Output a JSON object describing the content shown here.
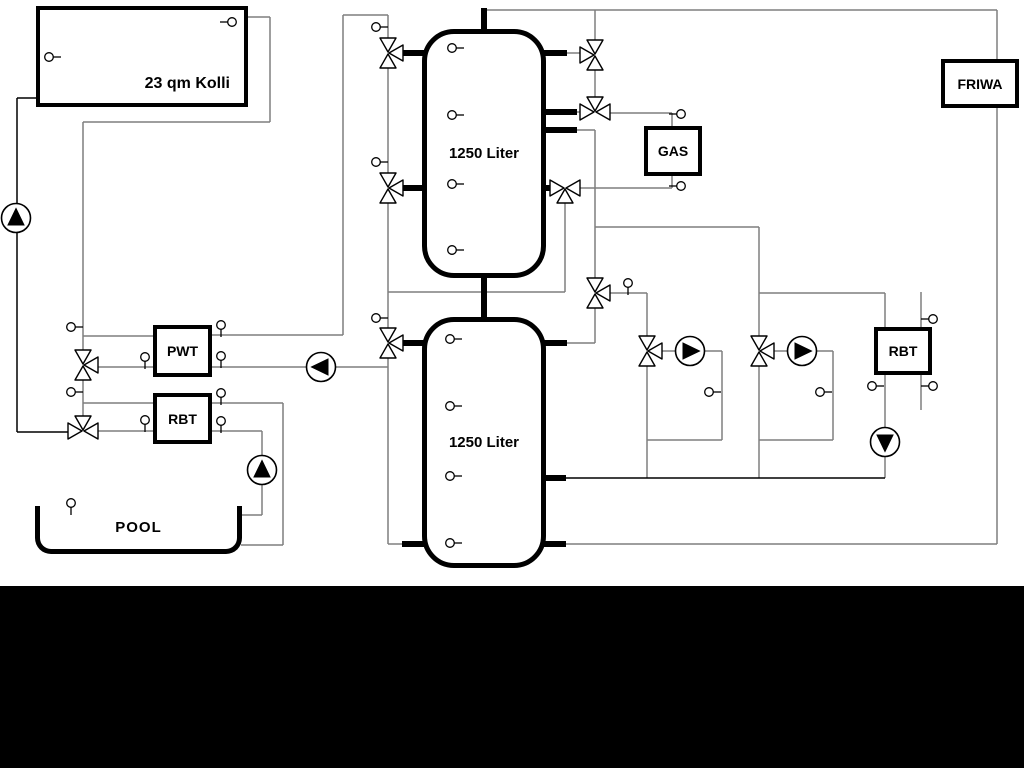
{
  "components": {
    "collector": {
      "label": "23 qm Kolli"
    },
    "tank_top": {
      "label": "1250 Liter"
    },
    "tank_bottom": {
      "label": "1250 Liter"
    },
    "gas_boiler": {
      "label": "GAS"
    },
    "friwa": {
      "label": "FRIWA"
    },
    "pwt": {
      "label": "PWT"
    },
    "rbt_pool": {
      "label": "RBT"
    },
    "rbt_heating": {
      "label": "RBT"
    },
    "pool": {
      "label": "POOL"
    }
  },
  "colors": {
    "pipe_gray": "#7f7f7f",
    "pipe_black": "#000000"
  },
  "icons": {
    "pump": "circle with filled flow-direction triangle",
    "three_way_valve": "three outlined triangles meeting at center",
    "sensor": "small circle with tick mark"
  }
}
